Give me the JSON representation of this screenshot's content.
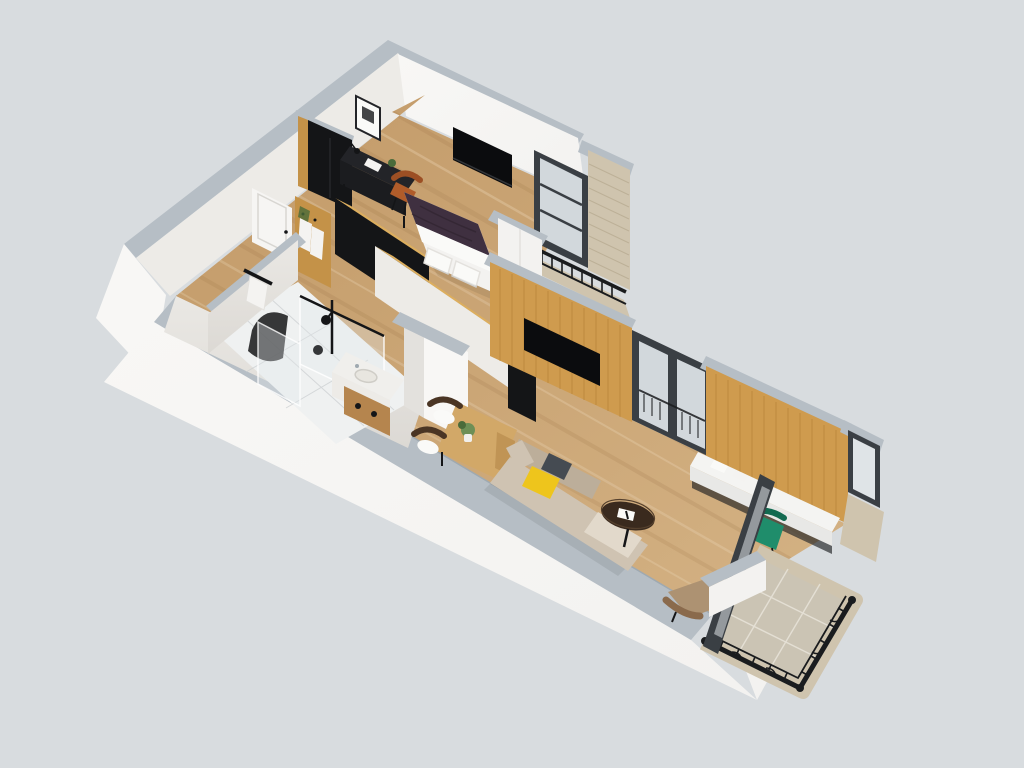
{
  "scene": {
    "title": "3D isometric cutaway floor plan of a studio apartment",
    "view": "axonometric top-down cutaway render",
    "background_color": "#d8dcdf"
  },
  "palette": {
    "bg": "#d8dcdf",
    "wallWhite": "#f3f2f0",
    "wallBright": "#f8f7f5",
    "wallInterior": "#edebe7",
    "wallShade": "#e3e1dd",
    "capLight": "#b6bec5",
    "capMid": "#9fa9b0",
    "marble": "#eae8e4",
    "marbleDark": "#dcd9d4",
    "tileFloor": "#eff1f1",
    "grout": "#e7e3d8",
    "woodFloorA": "#c29a68",
    "woodFloorB": "#d4b284",
    "plankShadow": "#8b6539",
    "plankLight": "#f0ddc0",
    "woodPanel": "#cf9b4e",
    "woodPanelDark": "#a97732",
    "woodTop": "#dcae5e",
    "woodCabinet": "#b5854e",
    "woodSide": "#c49248",
    "blackFurniture": "#141517",
    "darkDesk": "#232428",
    "darkDeskFront": "#1b1c1f",
    "tvBlack": "#0b0c0e",
    "frameDark": "#3a3f44",
    "glass": "#dfe4e7",
    "glassTint": "rgba(223,229,233,0.92)",
    "showerGlass": "rgba(225,232,236,0.35)",
    "stone": "#cfc4ae",
    "stoneLine": "#b3a68c",
    "iron": "#1a1c1e",
    "bedPurple": "#3f3040",
    "bedPurpleDark": "#31232f",
    "bedWhite": "#f3f2f0",
    "pillowWhite": "#fafaf8",
    "sofaBeige": "#cfc3b2",
    "sofaDark": "#bcae9a",
    "sofaPad": "#e2d9cb",
    "pillowYellow": "#eec51c",
    "pillowGray": "#454b52",
    "coffeeTable": "#3a2a1e",
    "loungeChair": "#ad9272",
    "loungeChairDark": "#8a6a4c",
    "greenChair": "#1f8d6b",
    "chairOrange": "#b05c2a",
    "chairOrangeDark": "#9c4f24",
    "plantGreen": "#4a6b3a",
    "plantLeaf": "#6d8f56",
    "vaseWhite": "#f0efec",
    "consoleWhite": "#f4f4f2",
    "consoleFace": "#e8e8e6",
    "doorWhite": "#f6f5f3",
    "doorFrame": "#d8d6d2",
    "towelWhite": "#f4f3f1",
    "tableWood": "#d2a868",
    "tableWoodDark": "#c09455",
    "shadow": "rgba(0,0,0,0.08)"
  },
  "rooms": [
    {
      "id": "bedroom",
      "name": "Bedroom",
      "floor": "light oak plank flooring",
      "furniture": [
        "double-bed-purple-duvet",
        "white-pillows",
        "black-wardrobe-wood-trim",
        "black-writing-desk",
        "desk-lamp",
        "laptop",
        "potted-plant",
        "orange-desk-chair",
        "wall-mounted-tv",
        "framed-abstract-picture",
        "white-closet-column",
        "wood-top-headboard-unit"
      ]
    },
    {
      "id": "bathroom",
      "name": "Bathroom",
      "floor": "white tile",
      "walls": "white marble",
      "furniture": [
        "walk-in-shower-glass",
        "black-shower-head",
        "arched-dark-mirror",
        "vanity-marble-top-sink",
        "wood-vanity-cabinet",
        "black-towel-rail-with-towel"
      ]
    },
    {
      "id": "hallway",
      "name": "Entry hallway",
      "furniture": [
        "white-entry-door",
        "wood-coat-panel-with-robes",
        "wood-top-divider-closet"
      ]
    },
    {
      "id": "living-dining",
      "name": "Living / dining room",
      "floor": "light oak plank flooring",
      "furniture": [
        "oak-dining-table",
        "two-dark-wood-chairs-white-seats",
        "flower-centerpiece-vase",
        "beige-sofa",
        "yellow-pillow",
        "gray-pillow",
        "round-dark-coffee-table",
        "open-book",
        "tan-lounge-chair",
        "green-accent-chair",
        "white-console-desk",
        "wood-panel-tv-wall",
        "second-wood-panel-wall",
        "wall-mounted-tv-living"
      ]
    }
  ],
  "exterior": [
    {
      "id": "balcony-north",
      "name": "Juliet balcony (upper right)",
      "features": [
        "stone-brick-column",
        "dark-frame-glass-door",
        "wrought-iron-railing",
        "stone-ledge"
      ]
    },
    {
      "id": "balcony-east",
      "name": "Balcony (lower right)",
      "features": [
        "stone-tile-floor",
        "wrought-iron-railing",
        "dark-french-doors",
        "open-door-leaf",
        "corner-window"
      ]
    }
  ]
}
